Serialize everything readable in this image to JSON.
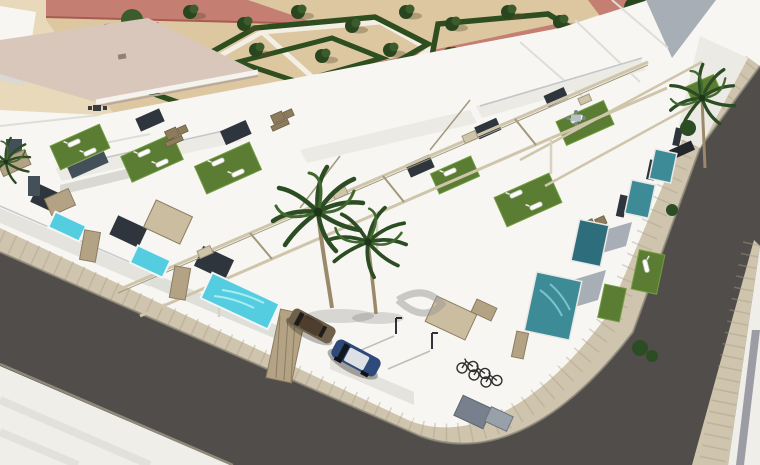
{
  "meta": {
    "width": 760,
    "height": 465,
    "title": "Aerial 3D architectural rendering of a modern white villa development"
  },
  "scene": {
    "type": "architectural-3d-rendering",
    "description": "Aerial corner view of rows of modern white townhouse villas with rooftop solarium terraces (artificial grass, sun loungers, wicker sofas, pergola beams), private plunge pools, palm trees, a landscaped park with geometric hedges and trees at the top, two asphalt streets with paved sidewalks meeting at a rounded corner, two parked cars and a bicycle shelter.",
    "objects": {
      "buildings": "two rows of white two-storey villas with rooftop terraces",
      "rooftop_features": [
        "artificial-grass",
        "sun-loungers",
        "wicker-sofas",
        "pergola-beams",
        "glass-railings"
      ],
      "bright_pools_visible": 3,
      "teal_pools_visible": 4,
      "large_palms": 3,
      "cars": 2,
      "bicycles": 3,
      "park": "geometric hedge parterres with small trees and red-sand walkways",
      "streets": [
        "foreground-avenue",
        "right-side-street"
      ]
    },
    "colors": {
      "sand": "#e8d9ba",
      "park_ground": "#dcc7a0",
      "path_red": "#c47f72",
      "path_red_deep": "#a85c50",
      "path_white": "#f3efe4",
      "hedge": "#2e4e20",
      "tree": "#2a461f",
      "tree_light": "#3c5c2e",
      "roof_pink": "#dac7bb",
      "red_roof": "#b25a4a",
      "wall_white": "#f7f6f2",
      "wall_light": "#eceae4",
      "wall_mid": "#d9d8d3",
      "wall_shade": "#a7aeb6",
      "wall_dark": "#6e747c",
      "window": "#2e353d",
      "window2": "#434f59",
      "grass": "#5a7d33",
      "grass_light": "#739d40",
      "pool_bright": "#55cde0",
      "pool_ripple": "#a8ecf2",
      "pool_teal": "#3d8b97",
      "pool_deep": "#2e6e7c",
      "asphalt": "#504d4a",
      "asphalt_light": "#5d5a56",
      "sidewalk": "#cfc4ad",
      "sidewalk_joint": "#a99d84",
      "curb": "#8f897a",
      "pavement": "#efeee9",
      "stripe": "#8d8d99",
      "pergola": "#cfc5aa",
      "pergola_dark": "#a2987e",
      "fence": "#b3a384",
      "fence_dark": "#8c7c60",
      "awning": "#cbbda0",
      "palm": "#2c4c24",
      "palm_light": "#41682f",
      "trunk": "#9a8a6a",
      "car_navy": "#2d4a7a",
      "car_navy_roof": "#dde0e4",
      "car_bronze": "#6f6049",
      "car_bronze_roof": "#4e3e2e",
      "bike": "#2f2f2f"
    }
  }
}
